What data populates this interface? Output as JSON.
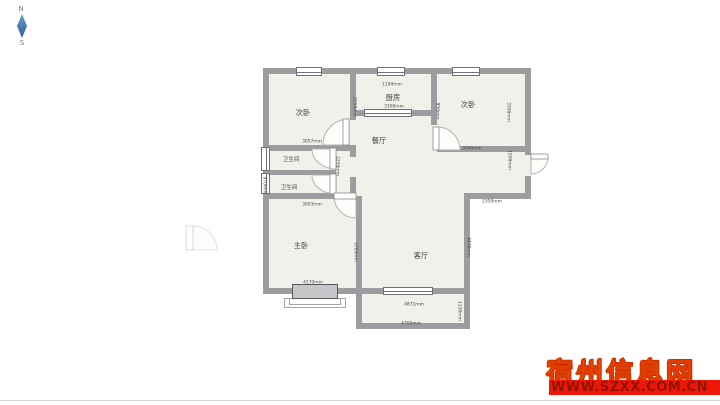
{
  "compass": {
    "north_label": "N",
    "south_label": "S"
  },
  "watermark": {
    "site_name": "宿州信息网",
    "site_url": "WWW.SZXX.COM.CN"
  },
  "colors": {
    "wall": "#9d9da1",
    "floor": "#f2f0ea",
    "watermark_gold": "#ffc615",
    "watermark_red": "#ee1607",
    "compass_needle_blue": "#2f5f96"
  },
  "floorplan": {
    "rooms": [
      {
        "name": "bedroom-secondary-left",
        "label": "次卧"
      },
      {
        "name": "kitchen",
        "label": "厨房"
      },
      {
        "name": "bedroom-secondary-right",
        "label": "次卧"
      },
      {
        "name": "dining-room",
        "label": "餐厅"
      },
      {
        "name": "bathroom-upper",
        "label": "卫生间"
      },
      {
        "name": "bathroom-lower",
        "label": "卫生间"
      },
      {
        "name": "master-bedroom",
        "label": "主卧"
      },
      {
        "name": "living-room",
        "label": "客厅"
      }
    ],
    "dimensions": {
      "bed_left_width": "3057mm",
      "bed_left_height": "2550mm",
      "kitchen_window": "1194mm",
      "kitchen_width": "3300mm",
      "bed_right_width": "3040mm",
      "bed_right_left_wall": "950mm",
      "bed_right_height": "3300mm",
      "bath_lower_height": "970mm",
      "corridor_height": "2250mm",
      "entry_wall": "1500mm",
      "entry_width": "2350mm",
      "master_top_width": "3903mm",
      "master_bottom_width": "4170mm",
      "living_height_left": "5703mm",
      "living_height_right": "4400mm",
      "living_width": "4871mm",
      "balcony_width": "4700mm",
      "balcony_height": "1230mm"
    }
  }
}
